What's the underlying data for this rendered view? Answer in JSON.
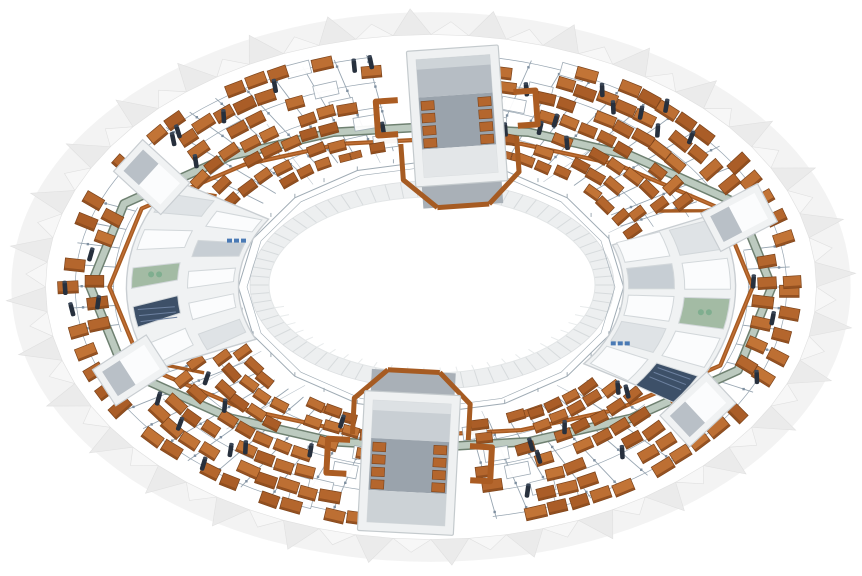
{
  "scene": {
    "kind": "isometric-3d-render",
    "subject": "ring-shaped industrial facility model (toroidal plant with magnet/panel arrays, service modules and arc buildings)",
    "canvas": {
      "width": 862,
      "height": 576,
      "background": "#ffffff"
    },
    "ring": {
      "cx": 431,
      "cy": 287,
      "radius_x": 426,
      "squash": 0.655
    },
    "hole": {
      "cx": 432,
      "cy": 285,
      "rx": 163,
      "ry": 88,
      "band_rx": 182,
      "band_ry": 104,
      "striations": 72,
      "band_color": "#edeff0",
      "striation_color": "#d7dbdd",
      "hole_color": "#ffffff",
      "inner_wall_color": "#e8ebec"
    },
    "rim": {
      "pleats": 64,
      "inner_frac": 0.905,
      "base_frac": 0.985,
      "apex_hi": 0.998,
      "apex_lo": 0.952,
      "fill_light": "#f7f7f7",
      "fill_dark": "#ebebeb",
      "stroke": "#e0e0e0",
      "base_fill": "#f3f3f3"
    },
    "panel_field": {
      "layers": [
        0.845,
        0.787,
        0.729,
        0.671,
        0.613,
        0.555,
        0.507
      ],
      "spacing": 21.5,
      "aspect_w": 19,
      "aspect_h": 12,
      "fills": [
        "#b4662d",
        "#bd6f33",
        "#aa5d27",
        "#c27436"
      ],
      "stroke": "#7a421a",
      "front_edge": "#8d4c1e",
      "inner_limit": 0.485,
      "outer_limit": 0.875,
      "aisle_every": 6,
      "sparse_density": 0.45
    },
    "rail_grid": {
      "radial_step_deg": 5.3,
      "r_from": 0.495,
      "r_to": 0.868,
      "tangential_rings": [
        0.565,
        0.655,
        0.745,
        0.835
      ],
      "line_color": "#97a5b1",
      "node_color": "#7e8fa0",
      "node_rings": [
        0.55,
        0.64,
        0.73,
        0.82
      ]
    },
    "walkway": {
      "radii16": [
        0.8,
        0.78,
        0.665,
        0.6,
        0.575,
        0.6,
        0.665,
        0.78,
        0.8,
        0.78,
        0.665,
        0.6,
        0.575,
        0.6,
        0.665,
        0.78
      ],
      "fill": "#bccabf",
      "edge": "#6f8171",
      "width": 6.5,
      "edge_width": 9.5
    },
    "pipes": {
      "ring_offset": -0.045,
      "color": "#a65b22",
      "highlight": "#c37137",
      "width": 4.2,
      "branches": [
        {
          "pts": [
            [
              150,
              0.615
            ],
            [
              157,
              0.7
            ],
            [
              157,
              0.79
            ]
          ]
        },
        {
          "pts": [
            [
              213,
              0.6
            ],
            [
              210,
              0.7
            ],
            [
              210,
              0.755
            ]
          ]
        },
        {
          "pts": [
            [
              30,
              0.615
            ],
            [
              36,
              0.7
            ],
            [
              36,
              0.79
            ]
          ]
        },
        {
          "pts": [
            [
              333,
              0.6
            ],
            [
              337,
              0.7
            ],
            [
              337,
              0.76
            ]
          ]
        }
      ],
      "inner_slab_angles": [
        248,
        292,
        62,
        118
      ]
    },
    "cylinders": {
      "count": 46,
      "color": "#27303d",
      "w": 4.6,
      "h": 13,
      "r_min": 0.52,
      "r_max": 0.86
    },
    "fence": {
      "radius": 0.452,
      "radius2": 0.432,
      "color": "#9fabb4",
      "posts": 32
    },
    "wires": {
      "angles": [
        100,
        130,
        150,
        170,
        200,
        233,
        255,
        285,
        305,
        335,
        20,
        50,
        75
      ],
      "color": "#b3bdc6"
    },
    "modules": {
      "north": {
        "x": 457,
        "y": 116,
        "rot": -4,
        "w": 92,
        "h": 136,
        "wall": "#eff1f2",
        "wall_stroke": "#c4cacd",
        "cavity": "#fcfdfd",
        "roof": "#b6bdc4",
        "roof_light": "#ced4d8",
        "floor": "#9aa3ac",
        "lower": "#e3e6e8",
        "apron": "#a9b0b7",
        "manifold_side": 1
      },
      "south": {
        "x": 409,
        "y": 463,
        "rot": 3,
        "w": 96,
        "h": 140,
        "wall": "#eff1f2",
        "wall_stroke": "#c4cacd",
        "cavity": "#fcfdfd",
        "roof": "#c9cfd4",
        "roof_light": "#dde1e4",
        "floor": "#9aa3ac",
        "lower": "#ccd2d6",
        "apron": "#a9b0b7",
        "manifold_side": -1
      }
    },
    "buildings": {
      "west": {
        "center_deg": 184,
        "span_deg": 57,
        "r_in": 0.452,
        "r_out": 0.715,
        "annex_degs": [
          157,
          211
        ],
        "room_fills_outer": [
          "#fbfcfd",
          "#3d5068",
          "#a3bba4",
          "#fbfcfd",
          "#dfe3e6"
        ],
        "room_fills_inner": [
          "#dfe3e6",
          "#fbfcfd",
          "#fbfcfd",
          "#c7ced4",
          "#fbfcfd"
        ]
      },
      "east": {
        "center_deg": 8,
        "span_deg": 59,
        "r_in": 0.452,
        "r_out": 0.715,
        "annex_degs": [
          341,
          35
        ],
        "room_fills_outer": [
          "#dfe3e6",
          "#fbfcfd",
          "#a3bba4",
          "#fbfcfd",
          "#3d5068"
        ],
        "room_fills_inner": [
          "#fbfcfd",
          "#c7ced4",
          "#fbfcfd",
          "#dfe3e6",
          "#fbfcfd"
        ]
      },
      "fill": "#f0f2f3",
      "stroke": "#c9ced2",
      "partition": "#d2d7da",
      "annex": {
        "w": 64,
        "h": 43,
        "inner": "#fbfcfd",
        "panel": "#b9c0c7"
      },
      "equip_blue": "#4a7ab5",
      "equip_pump": "#7fae8f"
    },
    "plaza_equipment": {
      "stroke": "#9aa7b2",
      "fill": "#ffffff",
      "count_per_side": 5
    }
  }
}
